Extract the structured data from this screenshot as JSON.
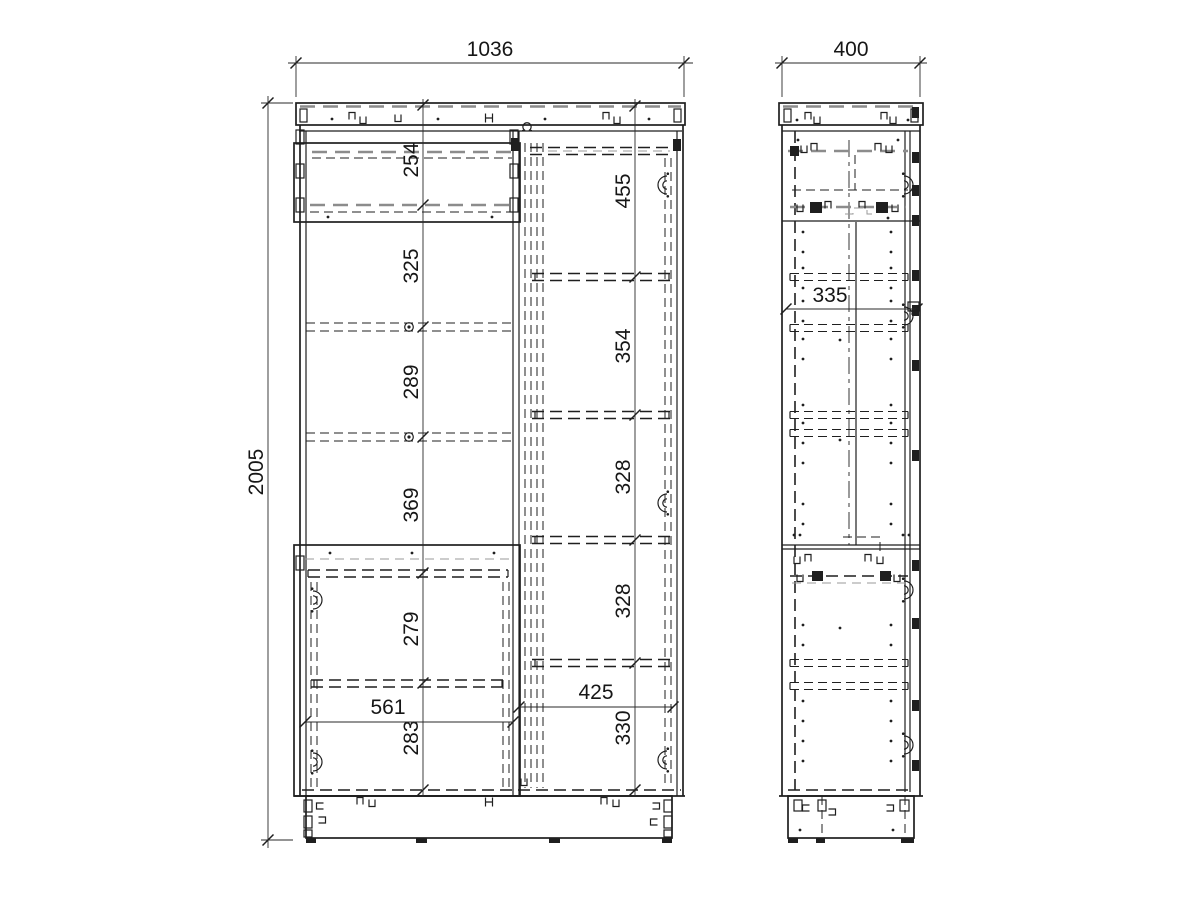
{
  "views": {
    "front": {
      "dimensions": {
        "overall_width": "1036",
        "overall_height": "2005",
        "left_column": [
          "254",
          "325",
          "289",
          "369",
          "279",
          "283"
        ],
        "right_column": [
          "455",
          "354",
          "328",
          "328",
          "330"
        ],
        "left_inner_width": "561",
        "right_inner_width": "425"
      }
    },
    "side": {
      "dimensions": {
        "overall_depth": "400",
        "inner_depth": "335"
      }
    }
  },
  "style": {
    "line_color": "#1f1f1f",
    "hidden_line_color": "#8c8c8c",
    "background": "#ffffff"
  }
}
